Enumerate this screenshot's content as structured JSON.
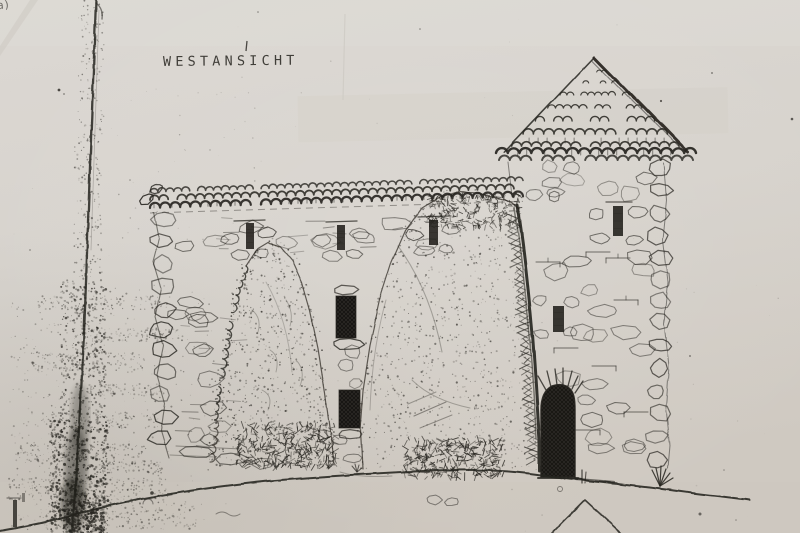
{
  "drawing": {
    "title": "WESTANSICHT",
    "corner_mark": "a)",
    "elements": {
      "main_building": "stone hall with tiled roof and slit windows",
      "tower": "round tower with conical tiled roof",
      "door": "dark arched entrance door",
      "rocks": "two rock outcrops in front of facade",
      "ground": "hillside ground line",
      "lower_gable": "gable apex of lower building",
      "artifact": "photocopy fold crease with toner smudge"
    }
  },
  "colors": {
    "paper": "#d9d5cf",
    "paper_light": "#dedbd6",
    "paper_dark": "#cdc7be",
    "ink": "#26241f",
    "smudge": "#1c1b18",
    "door_fill": "#2e2b27"
  }
}
